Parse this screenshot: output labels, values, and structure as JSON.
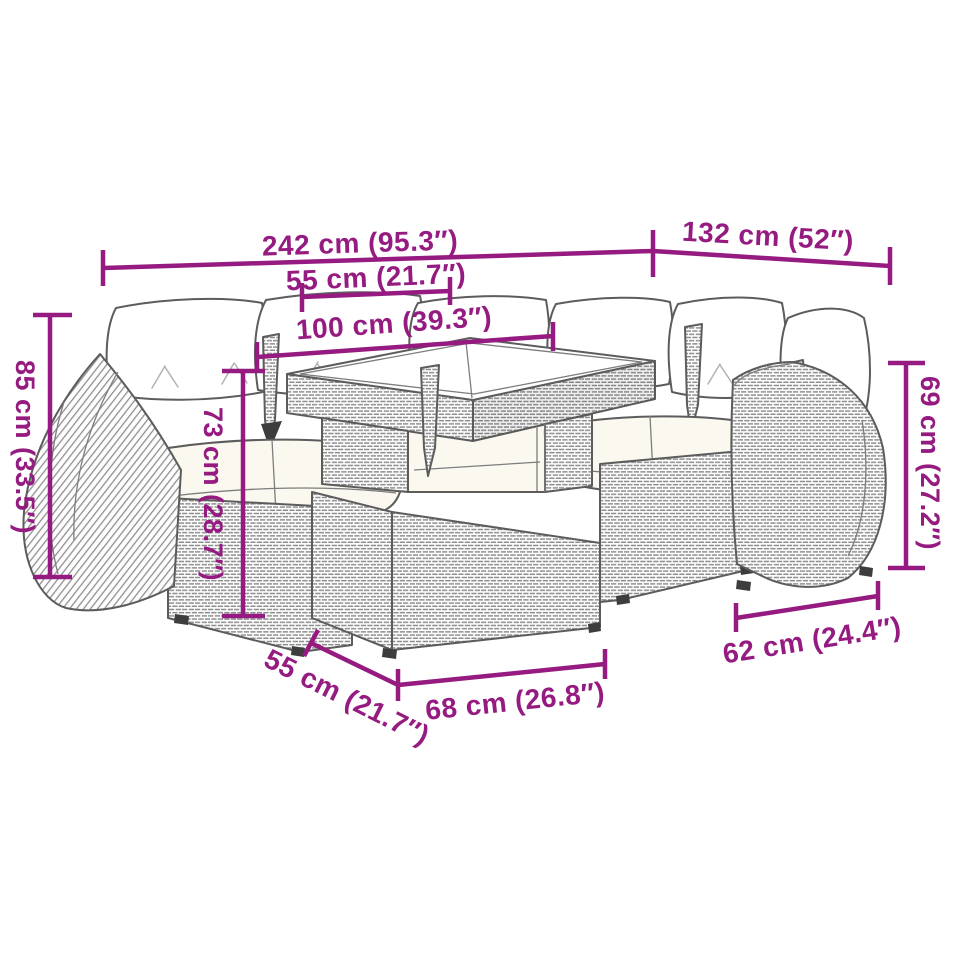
{
  "style": {
    "accent": "#951b81",
    "outline": "#5c5c5c",
    "background": "#ffffff"
  },
  "diagram": {
    "kind": "furniture-dimension-diagram",
    "subject": "rattan-garden-lounge-set-with-table"
  },
  "measurements": {
    "total_width": "242 cm (95.3″)",
    "corner_depth": "132 cm (52″)",
    "tabletop_panel": "55 cm (21.7″)",
    "tabletop_width": "100 cm (39.3″)",
    "back_height": "85 cm (33.5″)",
    "table_height": "73 cm (28.7″)",
    "armrest_height": "69 cm (27.2″)",
    "seat_module_width": "62 cm (24.4″)",
    "table_depth": "55 cm (21.7″)",
    "table_front_width": "68 cm (26.8″)"
  }
}
